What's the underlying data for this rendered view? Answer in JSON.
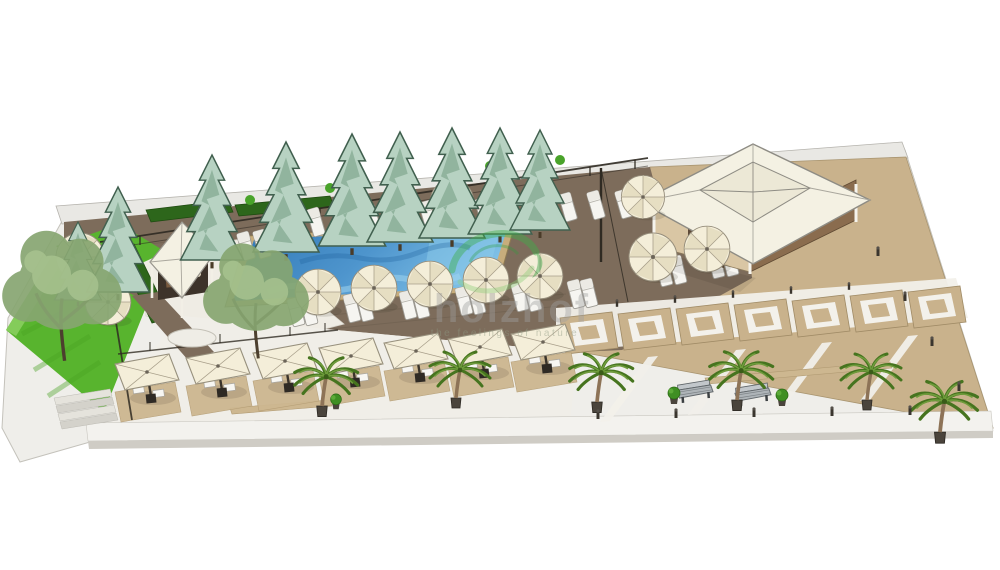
{
  "meta": {
    "type": "3d-architectural-render",
    "subject": "Resort pool terrace and plaza landscape visualization (SketchUp style)"
  },
  "watermark": {
    "text": "holzhof",
    "tagline": "the feelings of nature",
    "logo": "green-leaf-swirl"
  },
  "colors": {
    "background": "#ffffff",
    "wall_band": "#e9e8e4",
    "apron": "#efeeea",
    "deck_wood": "#7d6c5b",
    "plaza_tan": "#c9b28c",
    "pavement_white": "#f0eee8",
    "terrace_white": "#efece4",
    "walkway_white": "#f3f2ee",
    "grass": "#58b42e",
    "grass_light": "#8cd062",
    "hedge": "#2d661b",
    "pool_deep": "#2e76b5",
    "pool_light": "#7fc0e6",
    "pool_wave": "#9fd4ef",
    "coping": "#c8ad7c",
    "umbrella_cream": "#f4eed9",
    "umbrella_shade": "#e6dec2",
    "roof_white": "#f4f1e3",
    "roof_inner": "#ece8d6",
    "building_wall_tan": "#d9c6a4",
    "building_wall_brown": "#8a6c4e",
    "pine_body": "#b7d2c2",
    "pine_shade": "#84a992",
    "palm_dark": "#46741f",
    "palm_light": "#6f9c3c",
    "tree_olive": "#87a671",
    "tree_light": "#a9c490",
    "mat_tan": "#cdb790",
    "lounger_white": "#f6f5f1",
    "bench_gray": "#aeb4b8",
    "watermark_green": "#3fae49",
    "watermark_green_light": "#8fce79",
    "watermark_gray": "#9f9f9f"
  },
  "scene": {
    "elements": [
      {
        "label": "swimming pool",
        "count": 1
      },
      {
        "label": "wood pool deck",
        "count": 1
      },
      {
        "label": "pavilion building with hip roof",
        "count": 1
      },
      {
        "label": "pool bar gazebo",
        "count": 1
      },
      {
        "label": "pine trees",
        "count": 9
      },
      {
        "label": "deciduous trees",
        "count": 2
      },
      {
        "label": "palm trees",
        "count": 6
      },
      {
        "label": "round umbrellas",
        "count": 11
      },
      {
        "label": "square dining umbrellas",
        "count": 7
      },
      {
        "label": "sun loungers",
        "count": 31
      },
      {
        "label": "paver squares",
        "count": 7
      },
      {
        "label": "benches",
        "count": 2
      },
      {
        "label": "lawns",
        "count": 2
      },
      {
        "label": "entry steps",
        "count": 4
      }
    ]
  }
}
